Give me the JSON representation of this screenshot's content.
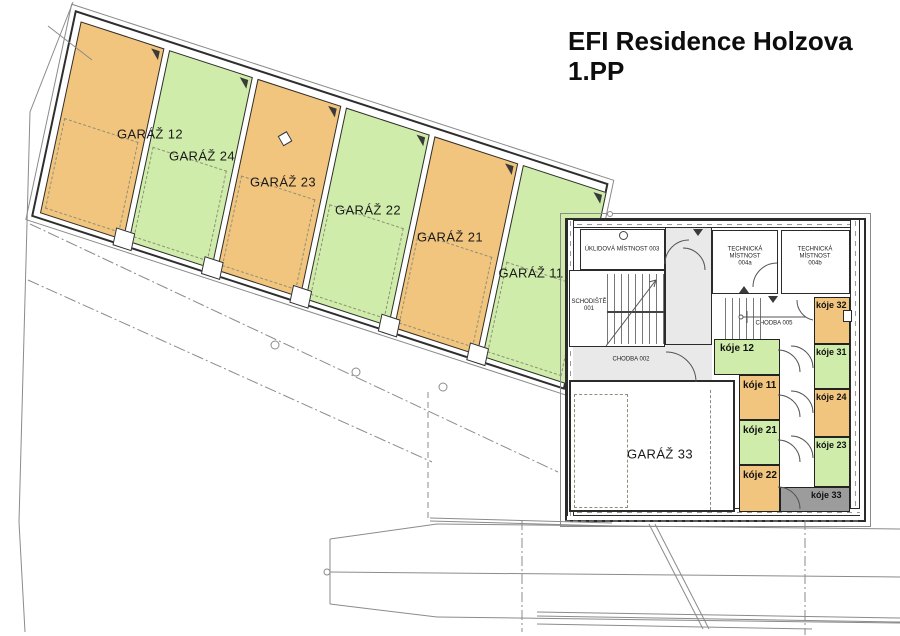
{
  "title": {
    "line1": "EFI Residence Holzova",
    "line2": "1.PP"
  },
  "colors": {
    "garage_orange": "#F2C57E",
    "garage_green": "#CFECAB",
    "cage_gray": "#9C9C9C",
    "corridor_gray": "#E9E9E9",
    "wall": "#2B2B2B"
  },
  "garages": {
    "g12": "GARÁŽ 12",
    "g24": "GARÁŽ 24",
    "g23": "GARÁŽ 23",
    "g22": "GARÁŽ 22",
    "g21": "GARÁŽ 21",
    "g11": "GARÁŽ 11",
    "g33": "GARÁŽ  33"
  },
  "rooms": {
    "uklidova": "ÚKLIDOVÁ MÍSTNOST 003",
    "technicka_a_name": "TECHNICKÁ MÍSTNOST",
    "technicka_a_num": "004a",
    "technicka_b_name": "TECHNICKÁ MÍSTNOST",
    "technicka_b_num": "004b",
    "schodiste_name": "SCHODIŠTĚ",
    "schodiste_num": "001",
    "chodba_002": "CHODBA 002",
    "chodba_005": "CHODBA 005"
  },
  "cages": {
    "k12": "kóje 12",
    "k11": "kóje 11",
    "k21": "kóje 21",
    "k22": "kóje 22",
    "k32": "kóje 32",
    "k31": "kóje 31",
    "k24": "kóje 24",
    "k23": "kóje 23",
    "k33": "kóje 33"
  }
}
